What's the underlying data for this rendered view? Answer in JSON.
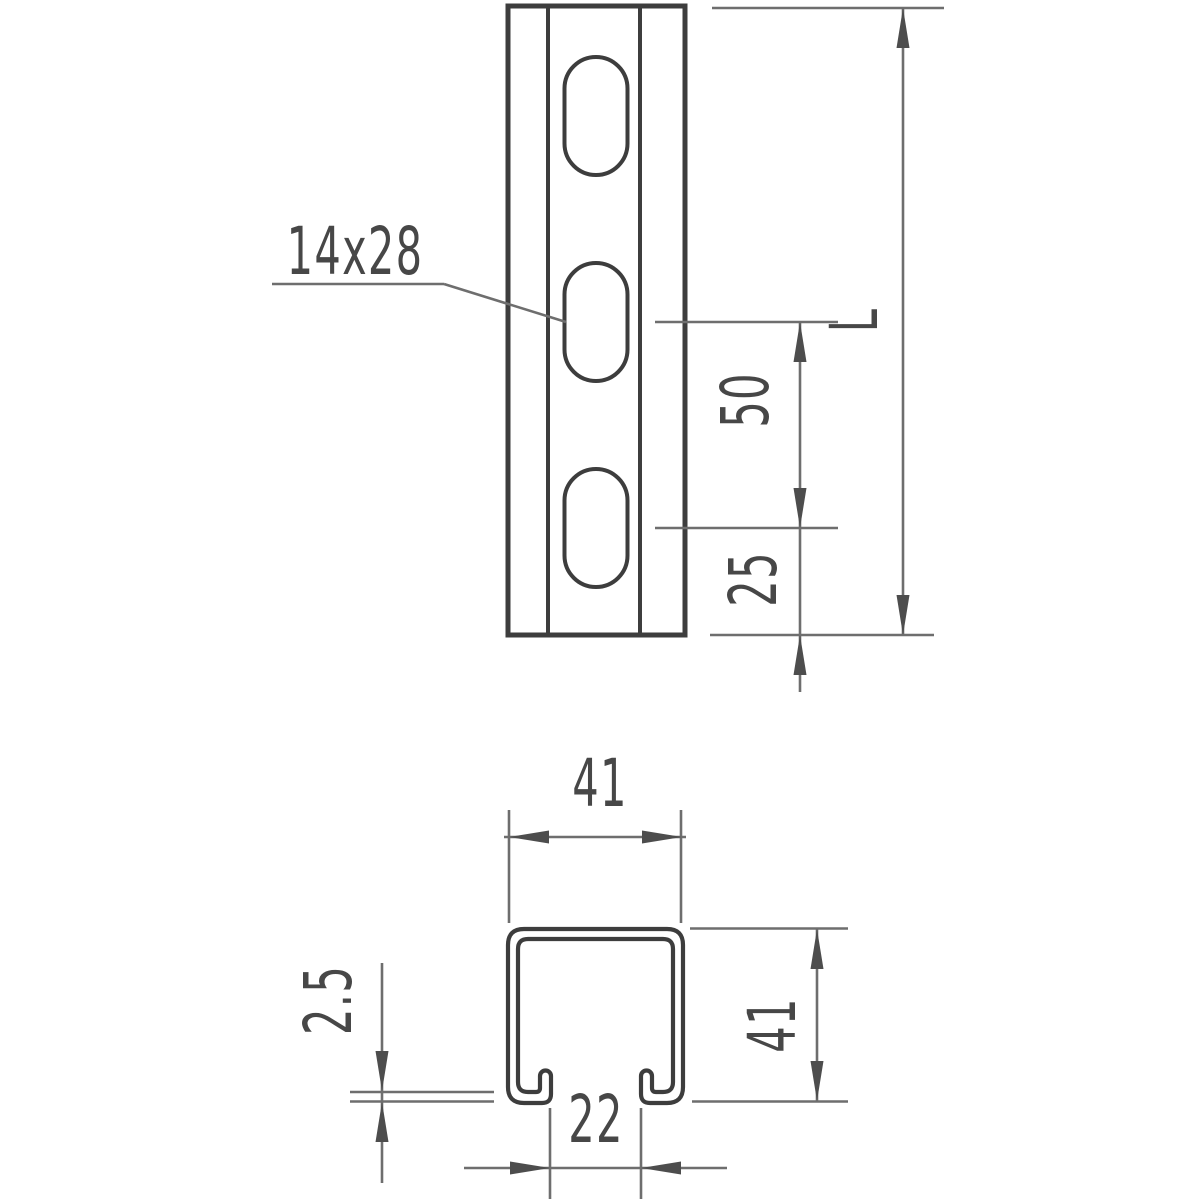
{
  "front_view": {
    "slot_size": "14x28",
    "slot_pitch": "50",
    "slot_end_distance": "25",
    "length_label": "L"
  },
  "section_view": {
    "outer_width": "41",
    "outer_height": "41",
    "opening_width": "22",
    "material_thickness": "2.5"
  },
  "colors": {
    "background": "#ffffff",
    "object_line": "#3d3d3d",
    "dimension_line": "#6e6e6e",
    "arrow": "#4d4d4d",
    "text": "#474747"
  }
}
